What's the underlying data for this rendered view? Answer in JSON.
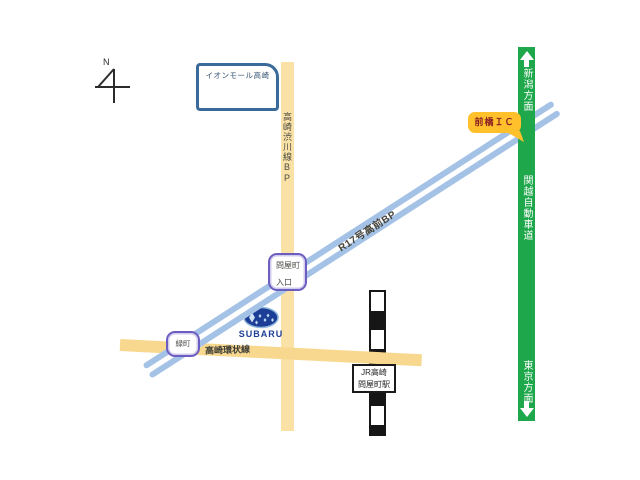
{
  "compass": {
    "north": "N"
  },
  "landmarks": {
    "aeon_mall": {
      "label": "イオンモール高崎"
    },
    "subaru_dealer": {
      "wordmark": "SUBARU"
    },
    "jr_station": {
      "line1": "JR高崎",
      "line2": "問屋町駅"
    }
  },
  "roads": {
    "shibukawa_bp": {
      "label": "高崎渋川線BP",
      "color": "#FAE2A6"
    },
    "ring_road": {
      "label": "高崎環状線",
      "color": "#F7D88E"
    },
    "r17_bp": {
      "label": "R17号高前BP",
      "color": "#A4C2E6"
    },
    "kanetsu_expressway": {
      "label": "関越自動車道",
      "color": "#1FA74B",
      "north_direction": "新潟方面",
      "south_direction": "東京方面"
    }
  },
  "markers": {
    "maebashi_ic": {
      "label": "前橋ＩＣ",
      "fill": "#FFC02C",
      "text_color": "#8A1F24"
    },
    "toiyamachi_entrance": {
      "line1": "問屋町",
      "line2": "入口",
      "border_color": "#6C5EC0"
    },
    "midoricho": {
      "label": "緑町",
      "border_color": "#6C5EC0"
    }
  }
}
